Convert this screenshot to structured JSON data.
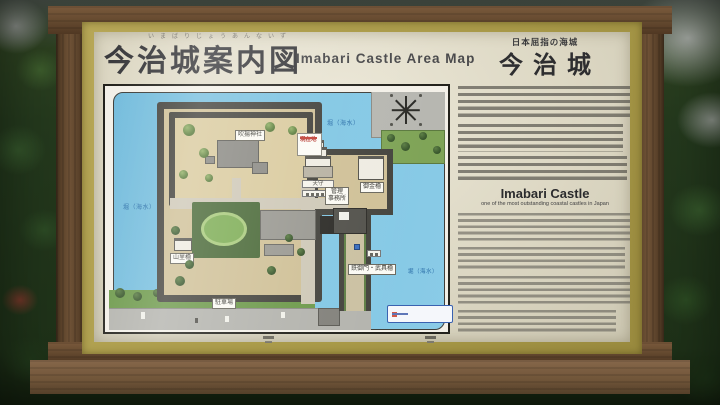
{
  "header": {
    "furigana": "いまばりじょうあんないず",
    "title_ja": "今治城案内図",
    "title_en": "Imabari Castle Area Map"
  },
  "info_panel": {
    "tagline": "日本屈指の海城",
    "castle_name": "今治城",
    "heading_en": "Imabari Castle",
    "subheading_en": "one of the most outstanding coastal castles in Japan"
  },
  "map": {
    "water_label": "堀（海水）",
    "labels": {
      "shrine": "吹揚神社",
      "keep": "天守",
      "you_are_here": "現在地",
      "office_line1": "管理",
      "office_line2": "事務所",
      "east_turret": "御金櫓",
      "west_turret": "山里櫓",
      "south_gate": "鉄御門・武具櫓",
      "parking": "駐車場"
    }
  },
  "colors": {
    "water": "#7cc3e0",
    "board_panel": "#ded9c6",
    "mat_border": "#aa9b4a",
    "wood_frame": "#6b4e33",
    "bailey_ground": "#d0c198",
    "stone_wall": "#46453f"
  }
}
